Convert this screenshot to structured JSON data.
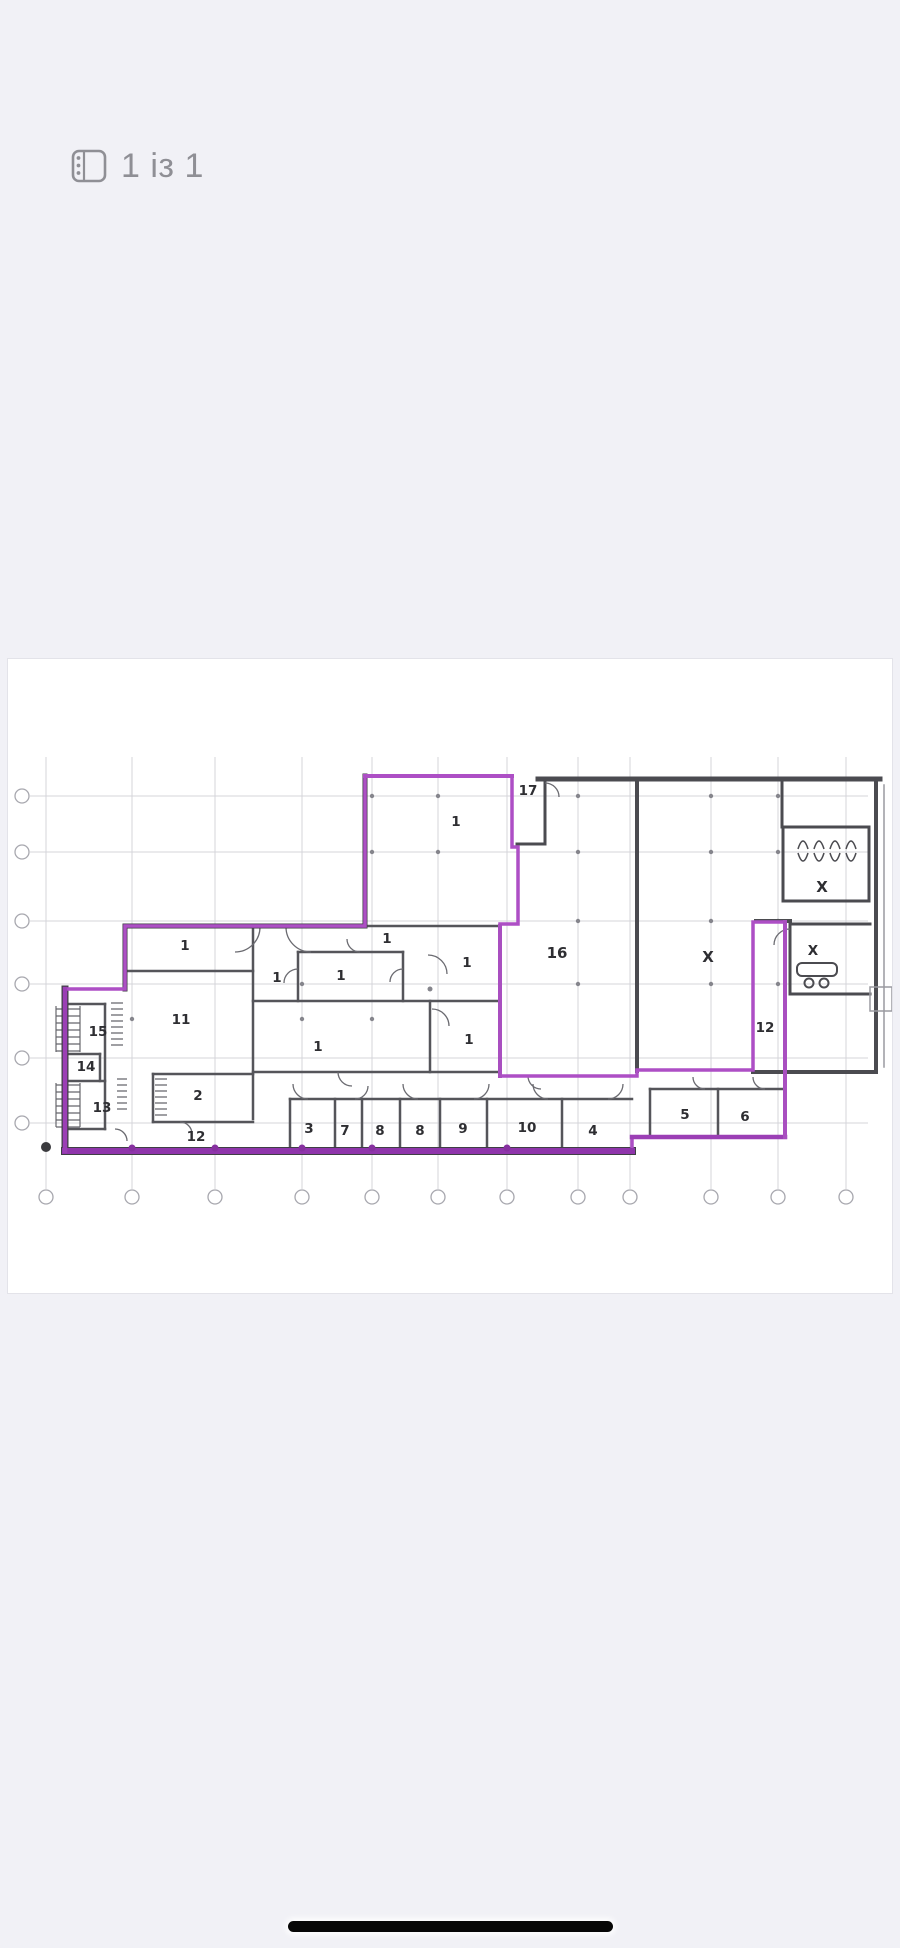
{
  "header": {
    "page_indicator": "1 із 1"
  },
  "viewer": {
    "background_color": "#f1f1f6",
    "page_background": "#ffffff",
    "home_indicator_color": "#070707"
  },
  "floor_plan": {
    "highlight_color": "#ad4fc5",
    "wall_color": "#4b4b50",
    "grid": {
      "vertical_lines": 12,
      "horizontal_lines": 6
    },
    "rooms": [
      {
        "label": "1"
      },
      {
        "label": "17"
      },
      {
        "label": "1"
      },
      {
        "label": "1"
      },
      {
        "label": "1"
      },
      {
        "label": "1"
      },
      {
        "label": "1"
      },
      {
        "label": "16"
      },
      {
        "label": "X"
      },
      {
        "label": "X"
      },
      {
        "label": "X"
      },
      {
        "label": "11"
      },
      {
        "label": "15"
      },
      {
        "label": "14"
      },
      {
        "label": "13"
      },
      {
        "label": "2"
      },
      {
        "label": "12"
      },
      {
        "label": "1"
      },
      {
        "label": "1"
      },
      {
        "label": "3"
      },
      {
        "label": "7"
      },
      {
        "label": "8"
      },
      {
        "label": "8"
      },
      {
        "label": "9"
      },
      {
        "label": "10"
      },
      {
        "label": "4"
      },
      {
        "label": "5"
      },
      {
        "label": "6"
      },
      {
        "label": "12"
      }
    ]
  }
}
